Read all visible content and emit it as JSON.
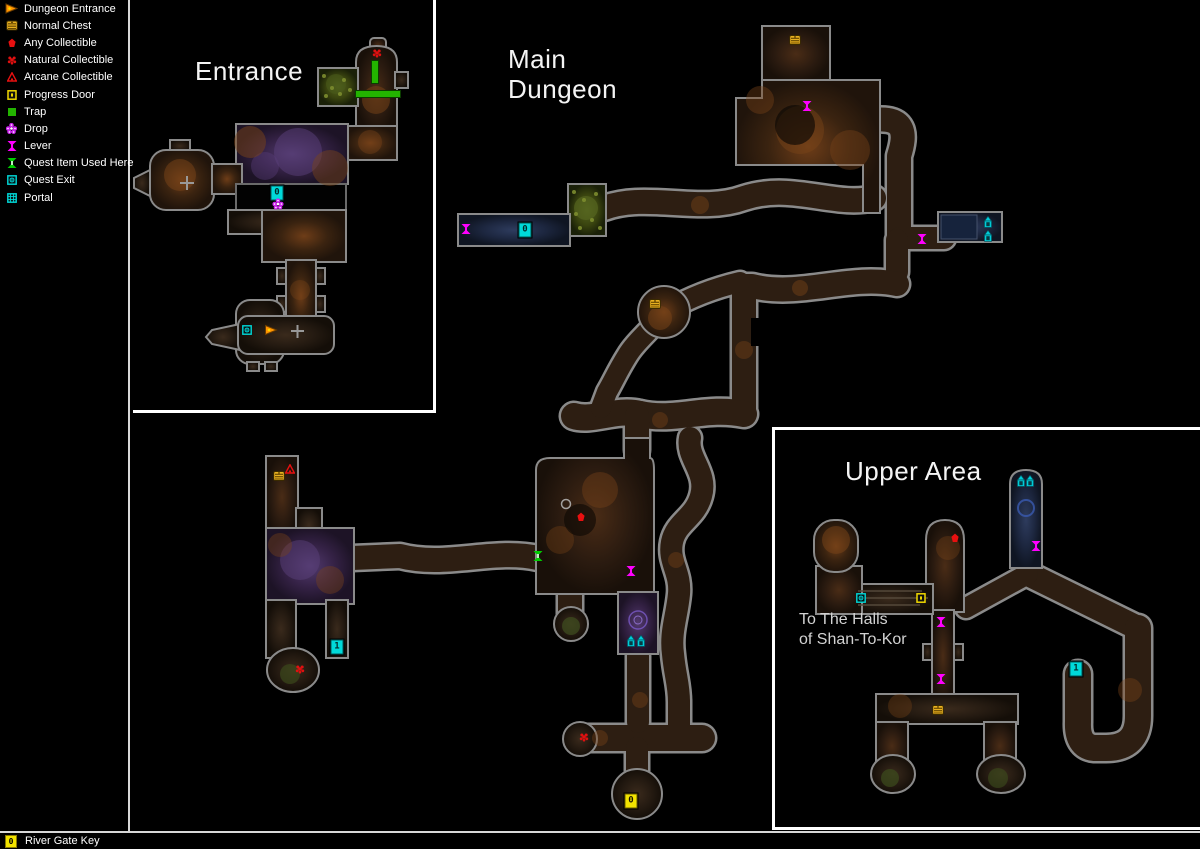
{
  "legend": {
    "items": [
      {
        "id": "dungeon-entrance",
        "label": "Dungeon Entrance"
      },
      {
        "id": "normal-chest",
        "label": "Normal Chest"
      },
      {
        "id": "any-collectible",
        "label": "Any Collectible"
      },
      {
        "id": "natural-collectible",
        "label": "Natural Collectible"
      },
      {
        "id": "arcane-collectible",
        "label": "Arcane Collectible"
      },
      {
        "id": "progress-door",
        "label": "Progress Door"
      },
      {
        "id": "trap",
        "label": "Trap"
      },
      {
        "id": "drop",
        "label": "Drop"
      },
      {
        "id": "lever",
        "label": "Lever"
      },
      {
        "id": "quest-item-used-here",
        "label": "Quest Item Used Here"
      },
      {
        "id": "quest-exit",
        "label": "Quest Exit"
      },
      {
        "id": "portal",
        "label": "Portal"
      }
    ]
  },
  "areas": {
    "entrance": {
      "title": "Entrance"
    },
    "main": {
      "title_line1": "Main",
      "title_line2": "Dungeon"
    },
    "upper": {
      "title": "Upper Area",
      "note_line1": "To The Halls",
      "note_line2": "of Shan-To-Kor"
    }
  },
  "status_bar": {
    "key_number": "0",
    "label": "River Gate Key"
  },
  "colors": {
    "lever": "#ff00ff",
    "trap": "#23b400",
    "collectible_red": "#e81010",
    "chest_gold": "#e8b020",
    "progress_door_yellow": "#f0d800",
    "quest_cyan": "#00d8d8",
    "entrance_orange": "#ff9400",
    "wall_gray": "#8a8a8a",
    "frame_white": "#ffffff"
  },
  "markers": [
    {
      "type": "natural",
      "x": 377,
      "y": 53
    },
    {
      "type": "trap",
      "x": 375,
      "y": 72,
      "w": 6,
      "h": 22
    },
    {
      "type": "trap",
      "x": 378,
      "y": 94,
      "w": 44,
      "h": 6
    },
    {
      "type": "portal-num",
      "label": "0",
      "x": 277,
      "y": 193
    },
    {
      "type": "drop",
      "x": 278,
      "y": 204
    },
    {
      "type": "quest-exit",
      "x": 247,
      "y": 330
    },
    {
      "type": "entrance",
      "x": 271,
      "y": 330
    },
    {
      "type": "chest",
      "x": 795,
      "y": 40
    },
    {
      "type": "lever",
      "x": 807,
      "y": 106
    },
    {
      "type": "lever",
      "x": 466,
      "y": 229
    },
    {
      "type": "portal-num",
      "label": "0",
      "x": 525,
      "y": 230
    },
    {
      "type": "lever",
      "x": 922,
      "y": 239
    },
    {
      "type": "arch",
      "x": 988,
      "y": 222
    },
    {
      "type": "arch",
      "x": 988,
      "y": 236
    },
    {
      "type": "chest",
      "x": 655,
      "y": 304
    },
    {
      "type": "arcane",
      "x": 290,
      "y": 469
    },
    {
      "type": "chest",
      "x": 279,
      "y": 476
    },
    {
      "type": "any",
      "x": 581,
      "y": 517
    },
    {
      "type": "quest-item",
      "x": 538,
      "y": 556
    },
    {
      "type": "lever",
      "x": 631,
      "y": 571
    },
    {
      "type": "arch",
      "x": 631,
      "y": 641
    },
    {
      "type": "arch",
      "x": 641,
      "y": 641
    },
    {
      "type": "portal-num",
      "label": "1",
      "x": 337,
      "y": 647
    },
    {
      "type": "natural",
      "x": 300,
      "y": 669
    },
    {
      "type": "natural",
      "x": 584,
      "y": 737
    },
    {
      "type": "key-num",
      "label": "0",
      "x": 631,
      "y": 801
    },
    {
      "type": "arch",
      "x": 1021,
      "y": 481
    },
    {
      "type": "arch",
      "x": 1030,
      "y": 481
    },
    {
      "type": "any",
      "x": 955,
      "y": 538
    },
    {
      "type": "lever",
      "x": 1036,
      "y": 546
    },
    {
      "type": "quest-exit",
      "x": 861,
      "y": 598
    },
    {
      "type": "progress-door",
      "x": 921,
      "y": 598
    },
    {
      "type": "lever",
      "x": 941,
      "y": 622
    },
    {
      "type": "lever",
      "x": 941,
      "y": 679
    },
    {
      "type": "portal-num",
      "label": "1",
      "x": 1076,
      "y": 669
    },
    {
      "type": "chest",
      "x": 938,
      "y": 710
    }
  ]
}
